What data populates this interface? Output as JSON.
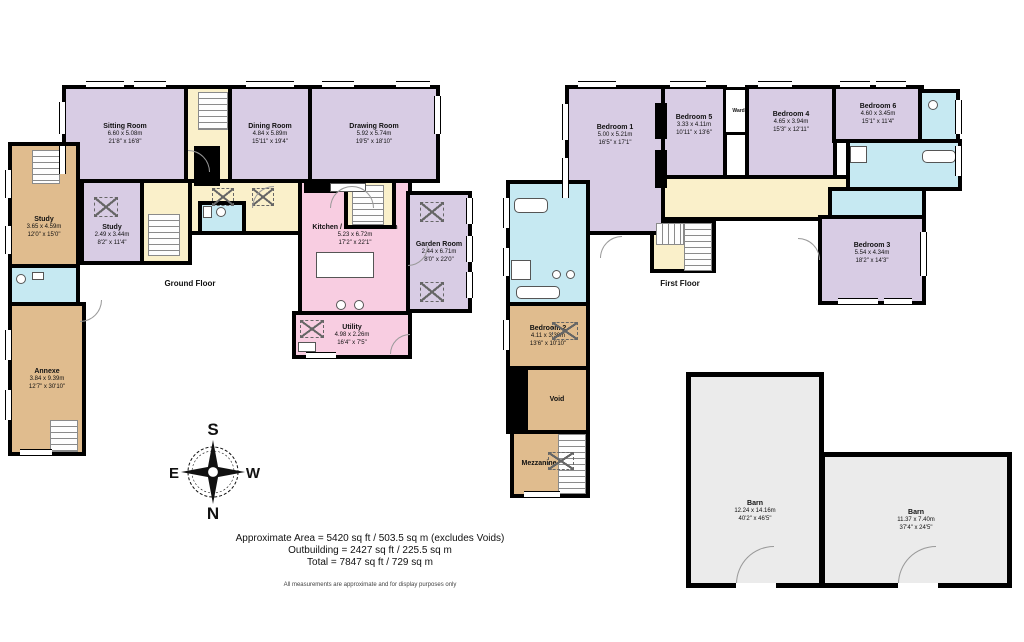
{
  "labels": {
    "ground_floor": "Ground Floor",
    "first_floor": "First Floor",
    "area_line1": "Approximate Area = 5420 sq ft / 503.5 sq m (excludes Voids)",
    "area_line2": "Outbuilding = 2427 sq ft / 225.5 sq m",
    "area_line3": "Total = 7847 sq ft / 729 sq m",
    "disclaimer": "All measurements are approximate and for display purposes only"
  },
  "compass": {
    "north": "N",
    "south": "S",
    "east": "E",
    "west": "W"
  },
  "colors": {
    "room_purple": "#d8cce4",
    "hall_cream": "#faf0ca",
    "kitchen_pink": "#f8cde1",
    "annexe_tan": "#e0bc8e",
    "bath_blue": "#c6e9f2",
    "barn_gray": "#ebebeb",
    "wall": "#000000"
  },
  "rooms": {
    "sitting_room": {
      "name": "Sitting Room",
      "metric": "6.60 x 5.08m",
      "imperial": "21'8\" x 16'8\""
    },
    "dining_room": {
      "name": "Dining Room",
      "metric": "4.84 x 5.89m",
      "imperial": "15'11\" x 19'4\""
    },
    "drawing_room": {
      "name": "Drawing Room",
      "metric": "5.92 x 5.74m",
      "imperial": "19'5\" x 18'10\""
    },
    "study": {
      "name": "Study",
      "metric": "2.49 x 3.44m",
      "imperial": "8'2\" x 11'4\""
    },
    "study_annexe": {
      "name": "Study",
      "metric": "3.65 x 4.59m",
      "imperial": "12'0\" x 15'0\""
    },
    "kitchen": {
      "name": "Kitchen / Breakfast Room",
      "metric": "5.23 x 6.72m",
      "imperial": "17'2\" x 22'1\""
    },
    "garden_room": {
      "name": "Garden Room",
      "metric": "2.44 x 6.71m",
      "imperial": "8'0\" x 22'0\""
    },
    "utility": {
      "name": "Utility",
      "metric": "4.98 x 2.26m",
      "imperial": "16'4\" x 7'5\""
    },
    "annexe": {
      "name": "Annexe",
      "metric": "3.84 x 9.39m",
      "imperial": "12'7\" x 30'10\""
    },
    "bedroom1": {
      "name": "Bedroom 1",
      "metric": "5.00 x 5.21m",
      "imperial": "16'5\" x 17'1\""
    },
    "bedroom5": {
      "name": "Bedroom 5",
      "metric": "3.33 x 4.11m",
      "imperial": "10'11\" x 13'6\""
    },
    "wardrobe": {
      "name": "Wardrobe"
    },
    "bedroom4": {
      "name": "Bedroom 4",
      "metric": "4.65 x 3.94m",
      "imperial": "15'3\" x 12'11\""
    },
    "bedroom6": {
      "name": "Bedroom 6",
      "metric": "4.60 x 3.45m",
      "imperial": "15'1\" x 11'4\""
    },
    "bedroom3": {
      "name": "Bedroom 3",
      "metric": "5.54 x 4.34m",
      "imperial": "18'2\" x 14'3\""
    },
    "bedroom2": {
      "name": "Bedroom 2",
      "metric": "4.11 x 3.30m",
      "imperial": "13'6\" x 10'10\""
    },
    "void": {
      "name": "Void"
    },
    "mezzanine": {
      "name": "Mezzanine"
    },
    "barn_large": {
      "name": "Barn",
      "metric": "12.24 x 14.16m",
      "imperial": "40'2\" x 46'5\""
    },
    "barn_small": {
      "name": "Barn",
      "metric": "11.37 x 7.40m",
      "imperial": "37'4\" x 24'5\""
    }
  }
}
